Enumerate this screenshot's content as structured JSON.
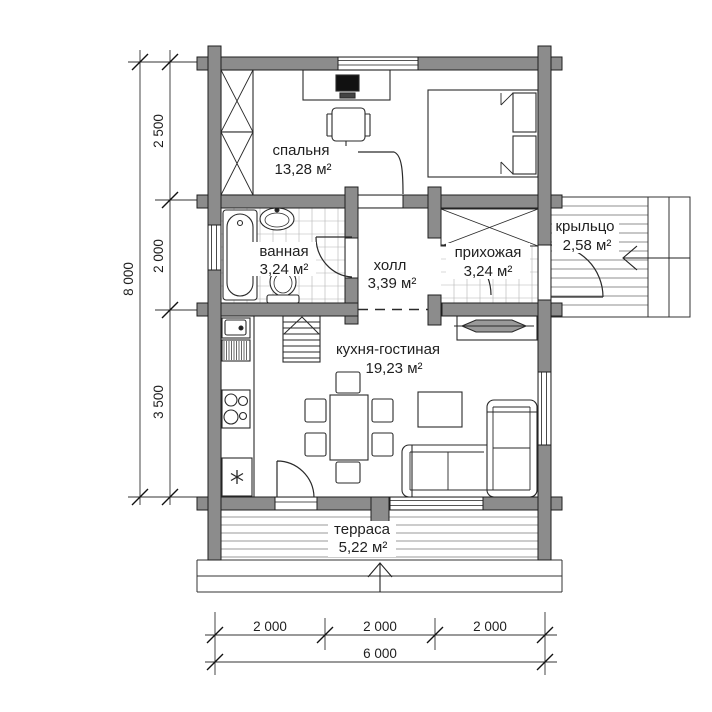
{
  "plan": {
    "type": "floor-plan",
    "rooms": {
      "bedroom": {
        "name": "спальня",
        "area": "13,28 м²"
      },
      "bathroom": {
        "name": "ванная",
        "area": "3,24 м²"
      },
      "hall": {
        "name": "холл",
        "area": "3,39 м²"
      },
      "entryway": {
        "name": "прихожая",
        "area": "3,24 м²"
      },
      "porch": {
        "name": "крыльцо",
        "area": "2,58 м²"
      },
      "kitchen_living": {
        "name": "кухня-гостиная",
        "area": "19,23 м²"
      },
      "terrace": {
        "name": "терраса",
        "area": "5,22 м²"
      }
    },
    "dimensions": {
      "left": {
        "segments": [
          "2 500",
          "2 000",
          "3 500"
        ],
        "total": "8 000"
      },
      "bottom": {
        "segments": [
          "2 000",
          "2 000",
          "2 000"
        ],
        "total": "6 000"
      }
    },
    "colors": {
      "wall_fill": "#8c8c8c",
      "line": "#1f1f1f",
      "tile_grid": "#b3b3b3",
      "deck_line": "#8f8f8f",
      "paper": "#ffffff"
    }
  }
}
